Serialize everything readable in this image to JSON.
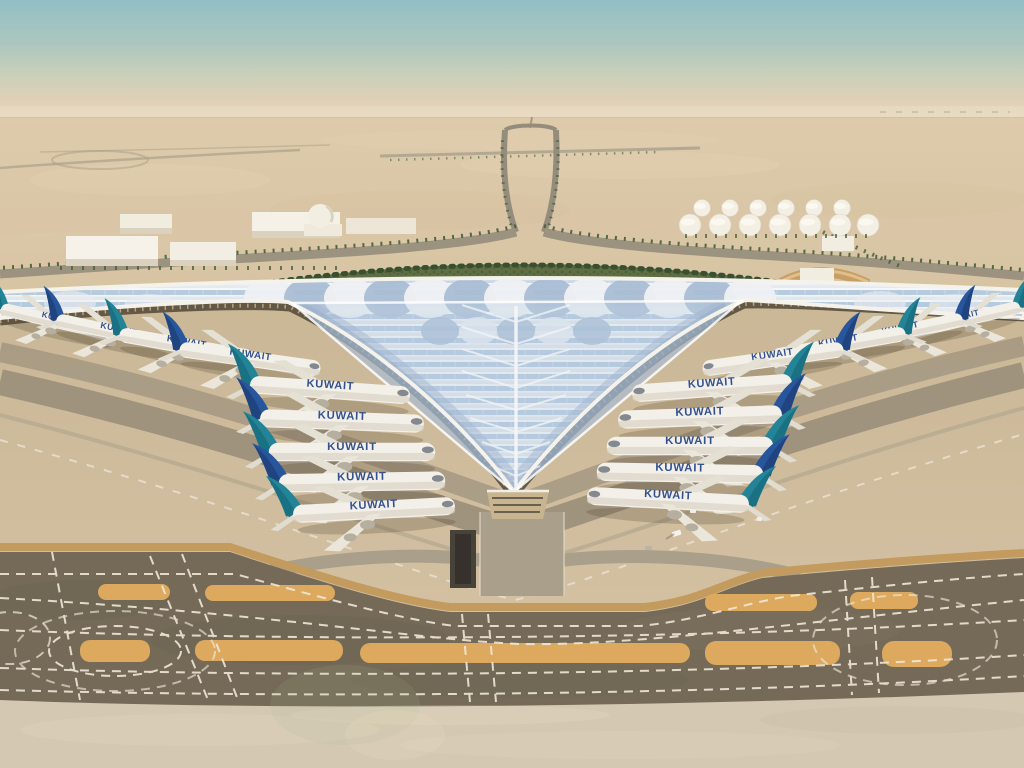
{
  "scene": {
    "description": "Aerial architectural rendering of a trefoil-roofed desert airport terminal (Kuwait International) with rows of Kuwait Airways jets parked along the swooping glazed wings, curved apron taxiways, palm-lined approach roads, warehouses, a domed building and a fuel tank farm in the background, and wide marked taxiway bands in the foreground.",
    "aircraft_label": "KUWAIT",
    "aircraft_count": 18,
    "airline": "Kuwait Airways",
    "palette": {
      "sky_top": "#8dbcc4",
      "sky_horizon": "#e7d9bf",
      "sand": "#d8c5a4",
      "roof_glass": "#aec6de",
      "roof_rib": "#f2f4f6",
      "tail_teal": "#177f93",
      "tail_blue": "#1d4f9a",
      "taxiway_dark": "#6e6452",
      "island_orange": "#dba659",
      "marking_white": "#efe8d7",
      "greenery": "#57693c"
    }
  }
}
